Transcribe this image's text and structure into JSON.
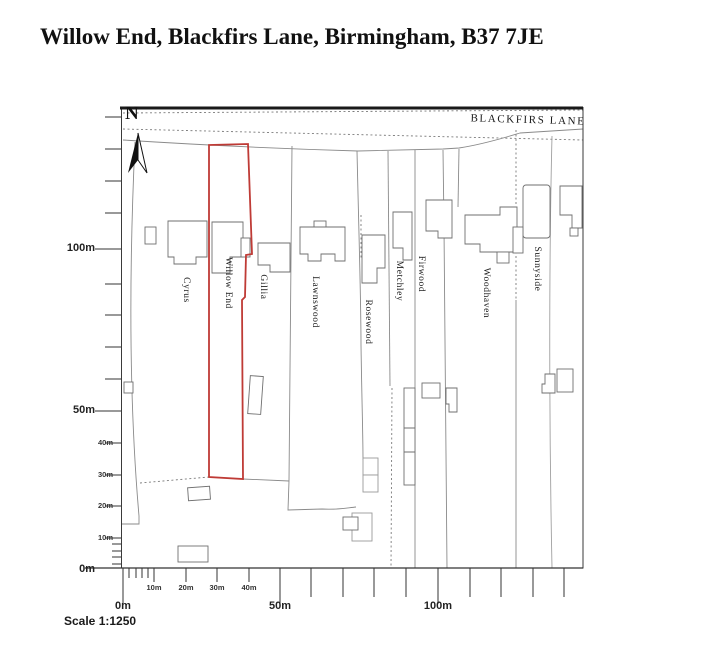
{
  "title": "Willow End, Blackfirs Lane, Birmingham, B37 7JE",
  "map": {
    "road_label": "BLACKFIRS LANE",
    "north_label": "N",
    "highlight_color": "#bf3b36",
    "highlighted_plot": "Willow End",
    "plot_labels": [
      {
        "name": "Cyrus",
        "x": 186,
        "y": 290
      },
      {
        "name": "Willow End",
        "x": 228,
        "y": 283
      },
      {
        "name": "Gillia",
        "x": 263,
        "y": 287
      },
      {
        "name": "Lawnswood",
        "x": 315,
        "y": 302
      },
      {
        "name": "Rosewood",
        "x": 368,
        "y": 322
      },
      {
        "name": "Metchley",
        "x": 399,
        "y": 281
      },
      {
        "name": "Firwood",
        "x": 421,
        "y": 274
      },
      {
        "name": "Woodhaven",
        "x": 486,
        "y": 293
      },
      {
        "name": "Sunnyside",
        "x": 537,
        "y": 269
      }
    ]
  },
  "scale": {
    "caption": "Scale 1:1250",
    "vertical_major": [
      {
        "text": "100m",
        "y": 249
      },
      {
        "text": "50m",
        "y": 411
      },
      {
        "text": "0m",
        "y": 570
      }
    ],
    "vertical_minor": [
      {
        "text": "40m",
        "y": 443
      },
      {
        "text": "30m",
        "y": 475
      },
      {
        "text": "20m",
        "y": 506
      },
      {
        "text": "10m",
        "y": 538
      }
    ],
    "horizontal_major": [
      {
        "text": "0m",
        "x": 123
      },
      {
        "text": "50m",
        "x": 280
      },
      {
        "text": "100m",
        "x": 438
      }
    ],
    "horizontal_minor": [
      {
        "text": "10m",
        "x": 154
      },
      {
        "text": "20m",
        "x": 186
      },
      {
        "text": "30m",
        "x": 217
      },
      {
        "text": "40m",
        "x": 249
      }
    ]
  }
}
